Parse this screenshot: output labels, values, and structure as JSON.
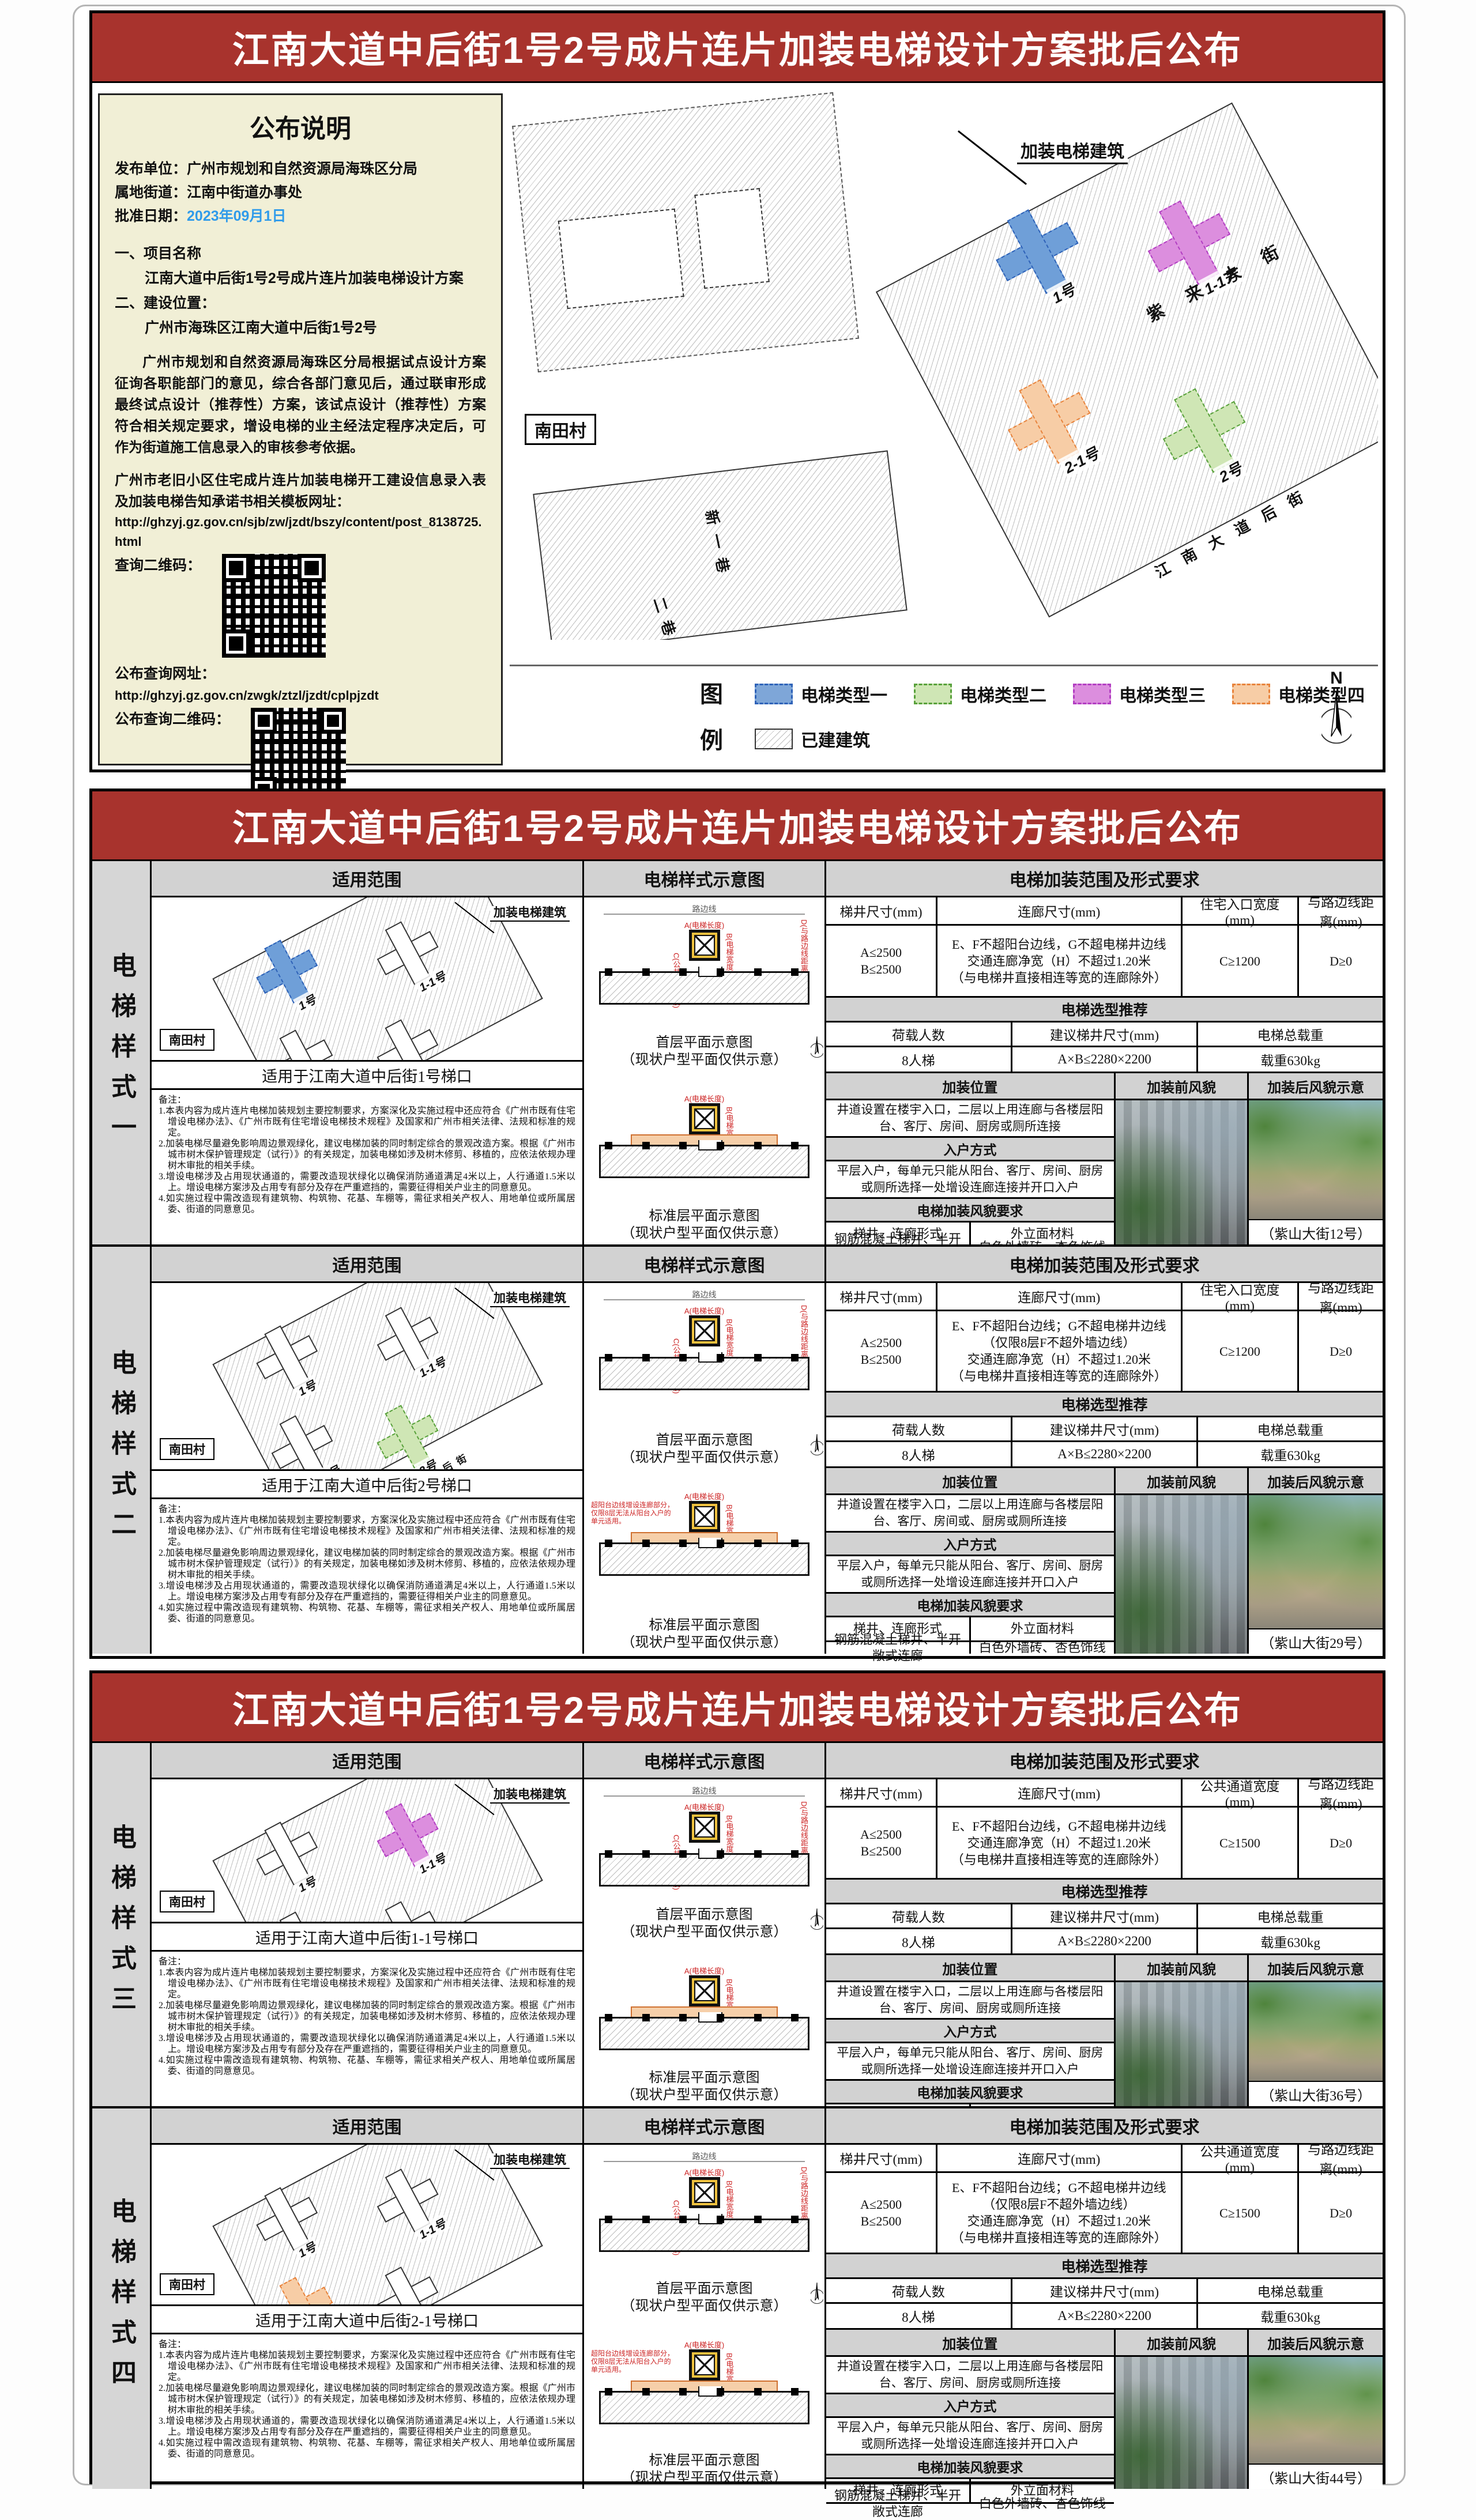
{
  "title": "江南大道中后街1号2号成片连片加装电梯设计方案批后公布",
  "notice": {
    "heading": "公布说明",
    "publisher_label": "发布单位：",
    "publisher": "广州市规划和自然资源局海珠区分局",
    "street_label": "属地街道：",
    "street": "江南中街道办事处",
    "date_label": "批准日期：",
    "date": "2023年09月1日",
    "sec1_no": "一、",
    "sec1_title": "项目名称",
    "sec1_text": "江南大道中后街1号2号成片连片加装电梯设计方案",
    "sec2_no": "二、",
    "sec2_title": "建设位置：",
    "sec2_text": "广州市海珠区江南大道中后街1号2号",
    "para1": "广州市规划和自然资源局海珠区分局根据试点设计方案征询各职能部门的意见，综合各部门意见后，通过联审形成最终试点设计（推荐性）方案，该试点设计（推荐性）方案符合相关规定要求，增设电梯的业主经法定程序决定后，可作为街道施工信息录入的审核参考依据。",
    "para2": "广州市老旧小区住宅成片连片加装电梯开工建设信息录入表及加装电梯告知承诺书相关模板网址：",
    "url1": "http://ghzyj.gz.gov.cn/sjb/zw/jzdt/bszy/content/post_8138725.html",
    "qr1_label": "查询二维码：",
    "query_url_label": "公布查询网址：",
    "url2": "http://ghzyj.gz.gov.cn/zwgk/ztzl/jzdt/cplpjzdt",
    "qr2_label": "公布查询二维码："
  },
  "map": {
    "callout": "加装电梯建筑",
    "village": "南田村",
    "street_main": "紫来大街",
    "street_back": "江南大道后街",
    "alley1": "新一巷",
    "alley2": "二巷",
    "b1": "1号",
    "b11": "1-1号",
    "b21": "2-1号",
    "b2": "2号"
  },
  "legend": {
    "title_char1": "图",
    "title_char2": "例",
    "items": [
      {
        "label": "电梯类型一",
        "fill": "#7ea6d8",
        "stroke": "#2e62b8"
      },
      {
        "label": "电梯类型二",
        "fill": "#cfe6b5",
        "stroke": "#58a13b"
      },
      {
        "label": "电梯类型三",
        "fill": "#dc8ede",
        "stroke": "#b23ec2"
      },
      {
        "label": "电梯类型四",
        "fill": "#f7cda6",
        "stroke": "#e8833c"
      }
    ],
    "built_label": "已建建筑",
    "north": "N"
  },
  "columns": {
    "scope": "适用范围",
    "diagram": "电梯样式示意图",
    "req": "电梯加装范围及形式要求"
  },
  "req_labels": {
    "shaft": "梯井尺寸(mm)",
    "corridor": "连廊尺寸(mm)",
    "road": "与路边线距离(mm)",
    "selection": "电梯选型推荐",
    "load": "荷载人数",
    "shaft_sugg": "建议梯井尺寸(mm)",
    "weight": "电梯总载重",
    "pos": "加装位置",
    "before": "加装前风貌",
    "after": "加装后风貌示意",
    "entry": "入户方式",
    "style_req": "电梯加装风貌要求",
    "form": "梯井、连廊形式",
    "material": "外立面材料"
  },
  "diagram_labels": {
    "first": "首层平面示意图",
    "std": "标准层平面示意图",
    "sub": "（现状户型平面仅供示意）",
    "road_line": "路边线",
    "dim_a": "A(电梯长度)",
    "dim_b": "B(电梯宽度)",
    "dim_c": "C(公共通道宽度)",
    "dim_d": "D(与路边线距离)"
  },
  "notes": {
    "label": "备注：",
    "items": [
      "1.本表内容为成片连片电梯加装规划主要控制要求，方案深化及实施过程中还应符合《广州市既有住宅增设电梯办法》、《广州市既有住宅增设电梯技术规程》及国家和广州市相关法律、法规和标准的规定。",
      "2.加装电梯尽量避免影响周边景观绿化，建议电梯加装的同时制定综合的景观改造方案。根据《广州市城市树木保护管理规定（试行）》的有关规定，加装电梯如涉及树木修剪、移植的，应依法依规办理树木审批的相关手续。",
      "3.增设电梯涉及占用现状通道的，需要改造现状绿化以确保消防通道满足4米以上，人行通道1.5米以上。增设电梯方案涉及占用专有部分及存在严重遮挡的，需要征得相关户业主的同意意见。",
      "4.如实施过程中需改造现有建筑物、构筑物、花基、车棚等，需征求相关产权人、用地单位或所属居委、街道的同意意见。"
    ]
  },
  "styles": [
    {
      "label": "电梯样式一",
      "accent": "#7ea6d8",
      "scope_caption": "适用于江南大道中后街1号梯口",
      "shaft_a": "A≤2500",
      "shaft_b": "B≤2500",
      "corridor": {
        "l1": "E、F不超阳台边线，G不超电梯井边线",
        "l2": "交通连廊净宽（H）不超过1.20米",
        "l3": "（与电梯井直接相连等宽的连廊除外）"
      },
      "width_header": "住宅入口宽度(mm)",
      "width_value": "C≥1200",
      "road_value": "D≥0",
      "load_value": "8人梯",
      "shaft_sugg_value": "A×B≤2280×2200",
      "weight_value": "载重630kg",
      "pos_text": "井道设置在楼宇入口，二层以上用连廊与各楼层阳台、客厅、房间、厨房或厕所连接",
      "entry_text": "平层入户，每单元只能从阳台、客厅、房间、厨房或厕所选择一处增设连廊连接并开口入户",
      "form_value": "钢筋混凝土梯井、半开敞式连廊",
      "material_value": "白色外墙砖、杏色饰线",
      "photo_caption": "（紫山大街12号）"
    },
    {
      "label": "电梯样式二",
      "accent": "#cfe6b5",
      "scope_caption": "适用于江南大道中后街2号梯口",
      "shaft_a": "A≤2500",
      "shaft_b": "B≤2500",
      "corridor": {
        "l1": "E、F不超阳台边线；G不超电梯井边线",
        "l2": "（仅限8层F不超外墙边线）",
        "l3": "交通连廊净宽（H）不超过1.20米",
        "l4": "（与电梯井直接相连等宽的连廊除外）"
      },
      "width_header": "住宅入口宽度(mm)",
      "width_value": "C≥1200",
      "road_value": "D≥0",
      "load_value": "8人梯",
      "shaft_sugg_value": "A×B≤2280×2200",
      "weight_value": "载重630kg",
      "pos_text": "井道设置在楼宇入口，二层以上用连廊与各楼层阳台、客厅、房间或、厨房或厕所连接",
      "entry_text": "平层入户，每单元只能从阳台、客厅、房间、厨房或厕所选择一处增设连廊连接并开口入户",
      "form_value": "钢筋混凝土梯井、半开敞式连廊",
      "material_value": "白色外墙砖、杏色饰线",
      "photo_caption": "（紫山大街29号）",
      "std_note1": "超阳台边线增设连廊部分，",
      "std_note2": "仅限8层无法从阳台入户的单元适用。"
    },
    {
      "label": "电梯样式三",
      "accent": "#dc8ede",
      "scope_caption": "适用于江南大道中后街1-1号梯口",
      "shaft_a": "A≤2500",
      "shaft_b": "B≤2500",
      "corridor": {
        "l1": "E、F不超阳台边线，G不超电梯井边线",
        "l2": "交通连廊净宽（H）不超过1.20米",
        "l3": "（与电梯井直接相连等宽的连廊除外）"
      },
      "width_header": "公共通道宽度(mm)",
      "width_value": "C≥1500",
      "road_value": "D≥0",
      "load_value": "8人梯",
      "shaft_sugg_value": "A×B≤2280×2200",
      "weight_value": "载重630kg",
      "pos_text": "井道设置在楼宇入口，二层以上用连廊与各楼层阳台、客厅、房间、厨房或厕所连接",
      "entry_text": "平层入户，每单元只能从阳台、客厅、房间、厨房或厕所选择一处增设连廊连接并开口入户",
      "form_value": "钢筋混凝土梯井、半开敞式连廊",
      "material_value": "白色外墙砖、杏色饰线",
      "photo_caption": "（紫山大街36号）"
    },
    {
      "label": "电梯样式四",
      "accent": "#f7cda6",
      "scope_caption": "适用于江南大道中后街2-1号梯口",
      "shaft_a": "A≤2500",
      "shaft_b": "B≤2500",
      "corridor": {
        "l1": "E、F不超阳台边线；G不超电梯井边线",
        "l2": "（仅限8层F不超外墙边线）",
        "l3": "交通连廊净宽（H）不超过1.20米",
        "l4": "（与电梯井直接相连等宽的连廊除外）"
      },
      "width_header": "公共通道宽度(mm)",
      "width_value": "C≥1500",
      "road_value": "D≥0",
      "load_value": "8人梯",
      "shaft_sugg_value": "A×B≤2280×2200",
      "weight_value": "载重630kg",
      "pos_text": "井道设置在楼宇入口，二层以上用连廊与各楼层阳台、客厅、房间、厨房或厕所连接",
      "entry_text": "平层入户，每单元只能从阳台、客厅、房间、厨房或厕所选择一处增设连廊连接并开口入户",
      "form_value": "钢筋混凝土梯井、半开敞式连廊",
      "material_value": "白色外墙砖、杏色饰线",
      "photo_caption": "（紫山大街44号）",
      "std_note1": "超阳台边线增设连廊部分，",
      "std_note2": "仅限8层无法从阳台入户的单元适用。"
    }
  ]
}
